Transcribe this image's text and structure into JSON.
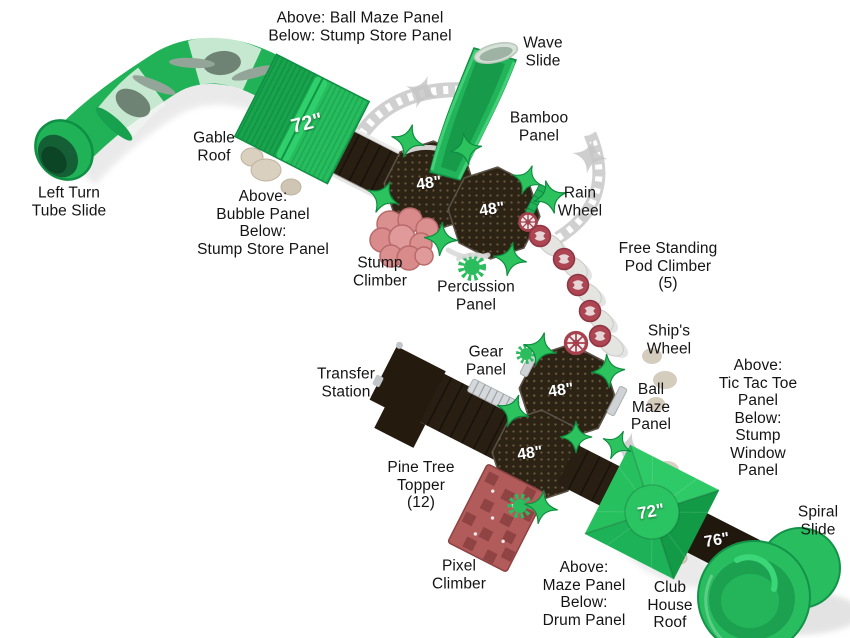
{
  "page": {
    "description": "Top-down render diagram of a commercial playground structure with labeled components"
  },
  "colors": {
    "green": "#21b257",
    "star_green": "#2cc35e",
    "deck_brown": "#2d2315",
    "stump_pink": "#db9090",
    "pixel_red": "#b25b5b",
    "pod_red": "#ad4553",
    "shadow_gray": "#c8c8c8",
    "label_text": "#141414",
    "marker_text": "#ffffff"
  },
  "labels": {
    "ball_maze_stump_store_note": "Above: Ball Maze Panel\nBelow: Stump Store Panel",
    "wave_slide": "Wave\nSlide",
    "gable_roof": "Gable\nRoof",
    "left_turn_tube_slide": "Left Turn\nTube Slide",
    "bamboo_panel": "Bamboo\nPanel",
    "rain_wheel": "Rain\nWheel",
    "bubble_stump_store_note": "Above:\nBubble Panel\nBelow:\nStump Store Panel",
    "stump_climber": "Stump\nClimber",
    "percussion_panel": "Percussion\nPanel",
    "free_standing_pod_climber": "Free Standing\nPod Climber\n(5)",
    "ships_wheel": "Ship's\nWheel",
    "gear_panel": "Gear\nPanel",
    "transfer_station": "Transfer\nStation",
    "ball_maze_panel": "Ball\nMaze\nPanel",
    "tic_tac_toe_stump_window_note": "Above:\nTic Tac Toe\nPanel\nBelow:\nStump Window\nPanel",
    "pine_tree_topper": "Pine Tree\nTopper\n(12)",
    "pixel_climber": "Pixel\nClimber",
    "maze_drum_note": "Above:\nMaze Panel\nBelow:\nDrum Panel",
    "club_house_roof": "Club\nHouse\nRoof",
    "spiral_slide": "Spiral\nSlide"
  },
  "height_markers": {
    "gable_roof": "72\"",
    "deck_a": "48\"",
    "deck_b": "48\"",
    "deck_c": "48\"",
    "deck_d": "48\"",
    "club_house_roof": "72\"",
    "spiral_deck": "76\""
  }
}
